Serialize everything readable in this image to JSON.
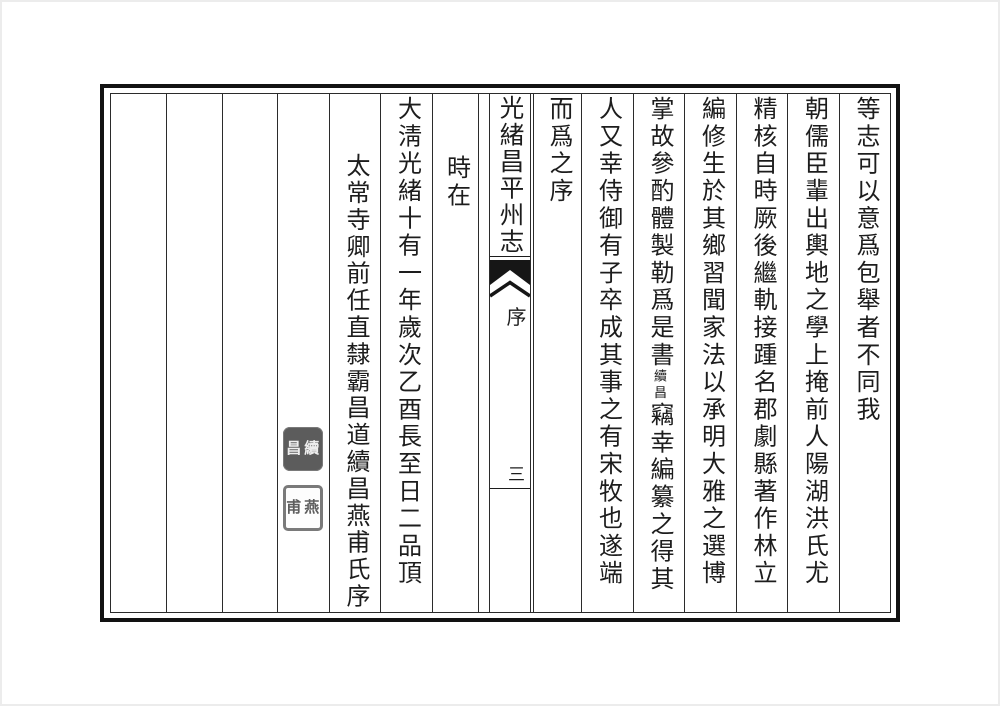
{
  "banxin": {
    "title": "光緒昌平州志",
    "section": "序",
    "page_number": "三"
  },
  "columns": [
    {
      "text": "等志可以意爲包舉者不同我"
    },
    {
      "text": "朝儒臣輩出輿地之學上掩前人陽湖洪氏尤爲"
    },
    {
      "text": "精核自時厥後繼軌接踵名郡劇縣著作林立繆"
    },
    {
      "text": "編修生於其鄉習聞家法以承明大雅之選博稽"
    },
    {
      "text_before": "掌故參酌體製勒爲是書",
      "interlinear_note": "續昌",
      "text_after": "竊幸編纂之得其"
    },
    {
      "text": "人又幸侍御有子卒成其事之有宋牧也遂端牘"
    },
    {
      "text": "而爲之序"
    },
    {
      "text": "時在"
    },
    {
      "text": "大淸光緒十有一年歲次乙酉長至日二品頂戴"
    },
    {
      "text": "太常寺卿前任直隸霸昌道續昌燕甫氏序"
    }
  ],
  "seals": [
    {
      "style": "white-on-dark",
      "chars": [
        "續",
        "昌"
      ]
    },
    {
      "style": "outline",
      "chars": [
        "燕",
        "甫"
      ]
    }
  ],
  "colors": {
    "ink": "#1d1d1d",
    "frame": "#121212",
    "seal_gray": "#5c5c5c"
  }
}
